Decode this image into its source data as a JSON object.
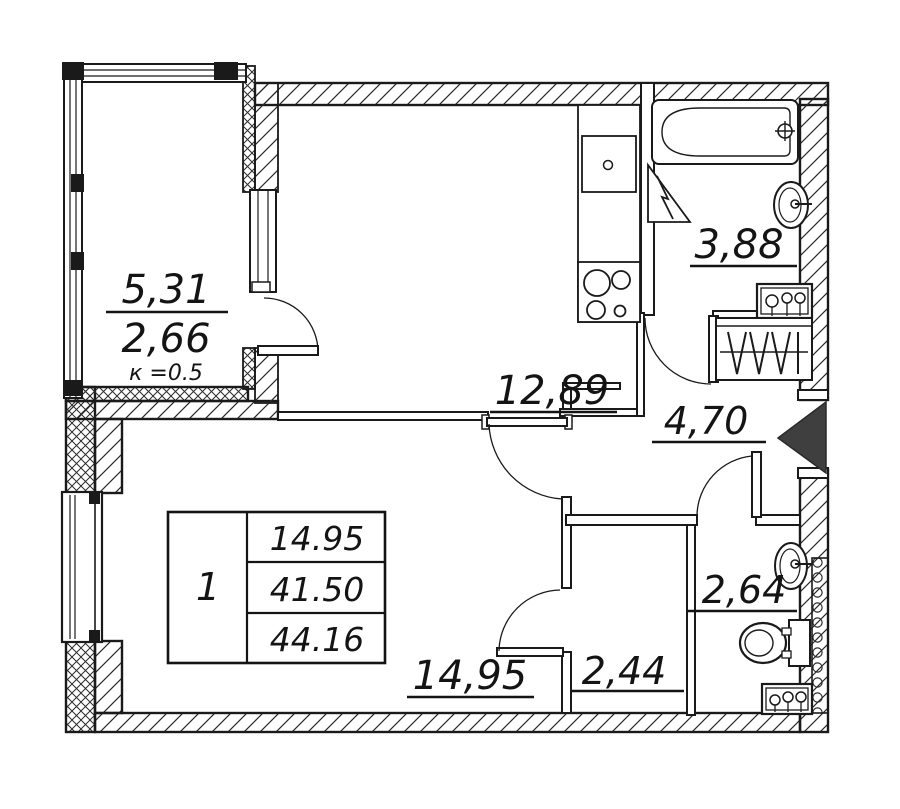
{
  "labels": {
    "balcony_area": "5,31",
    "balcony_reduced": "2,66",
    "balcony_coef": "к =0.5",
    "kitchen": "12,89",
    "bathroom": "3,88",
    "hallway": "4,70",
    "wc": "2,64",
    "closet": "2,44",
    "living": "14,95"
  },
  "table": {
    "rooms_count": "1",
    "living_area": "14.95",
    "area_without_balcony": "41.50",
    "total_area": "44.16"
  },
  "colors": {
    "line": "#1a1a1a",
    "entrance_arrow": "#3f3f3f",
    "background": "#ffffff"
  }
}
